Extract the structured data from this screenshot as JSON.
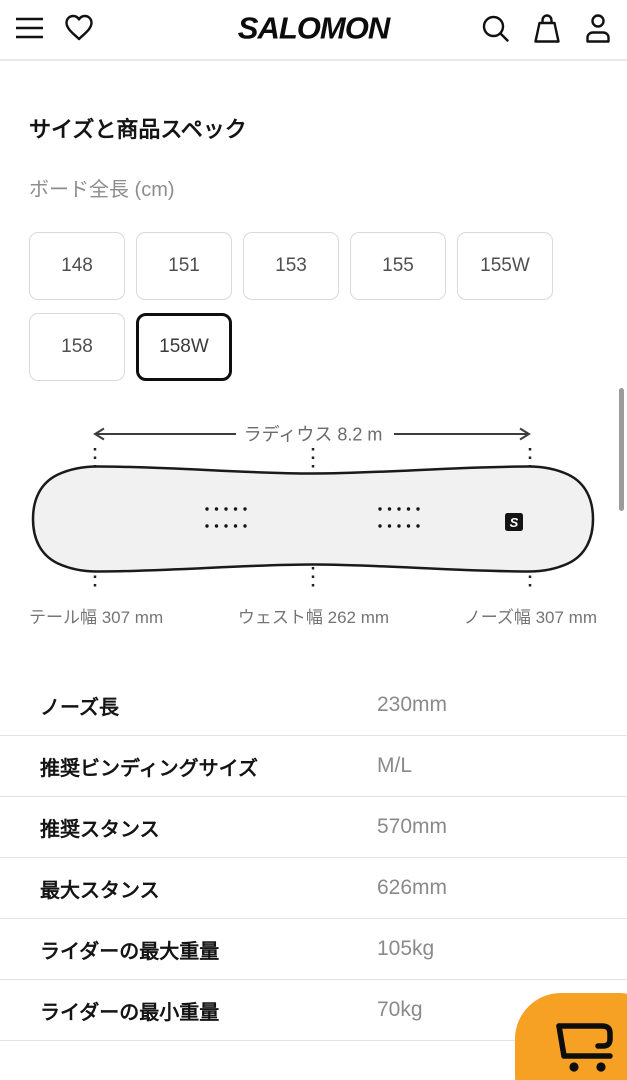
{
  "header": {
    "brand": "SALOMON",
    "icons": [
      "menu-icon",
      "heart-icon",
      "search-icon",
      "bag-icon",
      "account-icon"
    ]
  },
  "section": {
    "title": "サイズと商品スペック",
    "board_length_label": "ボード全長 (cm)"
  },
  "sizes": {
    "options": [
      "148",
      "151",
      "153",
      "155",
      "155W",
      "158",
      "158W"
    ],
    "selected": "158W"
  },
  "diagram": {
    "radius_label": "ラディウス 8.2 m",
    "tail_label": "テール幅 307 mm",
    "waist_label": "ウェスト幅 262 mm",
    "nose_label": "ノーズ幅 307 mm",
    "board_logo": "S"
  },
  "specs": {
    "rows": [
      {
        "label": "ノーズ長",
        "value": "230mm"
      },
      {
        "label": "推奨ビンディングサイズ",
        "value": "M/L"
      },
      {
        "label": "推奨スタンス",
        "value": "570mm"
      },
      {
        "label": "最大スタンス",
        "value": "626mm"
      },
      {
        "label": "ライダーの最大重量",
        "value": "105kg"
      },
      {
        "label": "ライダーの最小重量",
        "value": "70kg"
      }
    ]
  },
  "colors": {
    "accent_orange": "#F7A124",
    "board_fill": "#f1f1f1",
    "divider": "#e3e3e3"
  }
}
